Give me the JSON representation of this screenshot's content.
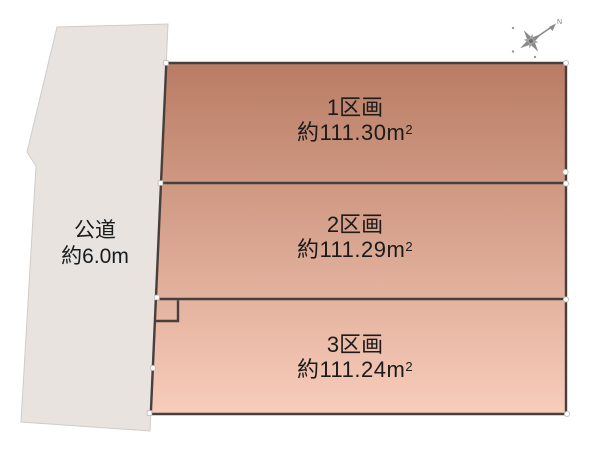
{
  "diagram": {
    "type": "land-subdivision-plot",
    "road": {
      "label": "公道",
      "width": "約6.0m"
    },
    "parcels": [
      {
        "label": "1区画",
        "area": "約111.30",
        "unit": "m",
        "unit_exp": "2"
      },
      {
        "label": "2区画",
        "area": "約111.29",
        "unit": "m",
        "unit_exp": "2"
      },
      {
        "label": "3区画",
        "area": "約111.24",
        "unit": "m",
        "unit_exp": "2"
      }
    ],
    "compass": {
      "north_label": "N"
    },
    "colors": {
      "parcel_gradient_top": "#b97c64",
      "parcel_gradient_bottom": "#f8cdbb",
      "road_fill": "#e8e3df",
      "road_edge": "#d2cbc7",
      "parcel_outline": "#463f3b",
      "text": "#1b1b1b",
      "compass_gray": "#8a8a8a",
      "handle_fill": "#ffffff"
    }
  }
}
